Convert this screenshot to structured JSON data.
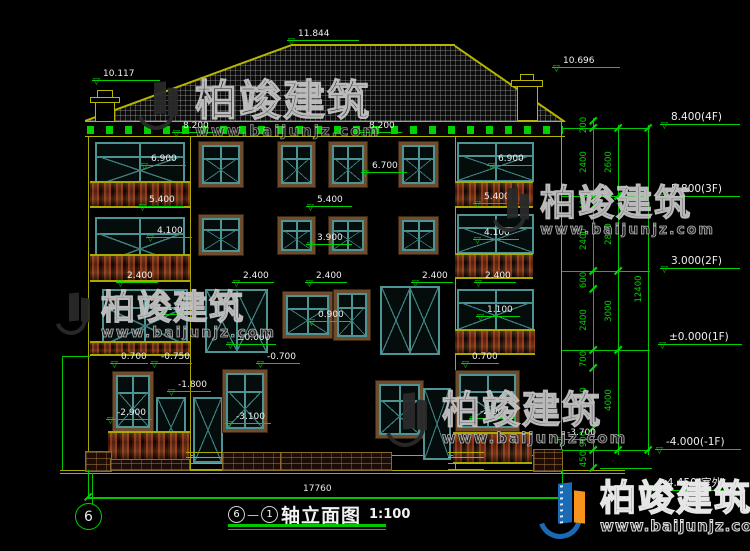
{
  "title": {
    "axis_start": "6",
    "separator": "—",
    "axis_end": "1",
    "name": "轴立面图",
    "scale": "1:100"
  },
  "axis_bubble": {
    "label": "6"
  },
  "watermark": {
    "brand": "柏竣建筑",
    "url": "www.baijunjz.com"
  },
  "dims": {
    "overall_width": "17760"
  },
  "colors": {
    "cad_yellow": "#a9a900",
    "cad_green": "#00d200",
    "window_teal": "#4e9494",
    "frame_brown": "#6e4c2e",
    "baluster_red": "#8a3418",
    "logo_blue": "#1a6ab5",
    "logo_orange": "#f7941d"
  },
  "levels": [
    {
      "t": "11.844",
      "x": 287,
      "y": 28,
      "w": 72
    },
    {
      "t": "10.117",
      "x": 92,
      "y": 68,
      "w": 68
    },
    {
      "t": "10.696",
      "x": 552,
      "y": 55,
      "w": 68
    },
    {
      "t": "8.200",
      "x": 172,
      "y": 120,
      "w": 44
    },
    {
      "t": "8.200",
      "x": 358,
      "y": 120,
      "w": 44
    },
    {
      "t": "6.900",
      "x": 140,
      "y": 153,
      "w": 46
    },
    {
      "t": "6.700",
      "x": 361,
      "y": 160,
      "w": 46
    },
    {
      "t": "6.900",
      "x": 487,
      "y": 153,
      "w": 46
    },
    {
      "t": "5.400",
      "x": 138,
      "y": 194,
      "w": 46
    },
    {
      "t": "5.400",
      "x": 306,
      "y": 194,
      "w": 46
    },
    {
      "t": "5.400",
      "x": 473,
      "y": 191,
      "w": 46
    },
    {
      "t": "4.100",
      "x": 146,
      "y": 225,
      "w": 46
    },
    {
      "t": "3.900",
      "x": 306,
      "y": 232,
      "w": 46
    },
    {
      "t": "4.100",
      "x": 473,
      "y": 227,
      "w": 46
    },
    {
      "t": "2.400",
      "x": 116,
      "y": 270,
      "w": 42
    },
    {
      "t": "2.400",
      "x": 232,
      "y": 270,
      "w": 42
    },
    {
      "t": "2.400",
      "x": 305,
      "y": 270,
      "w": 42
    },
    {
      "t": "2.400",
      "x": 411,
      "y": 270,
      "w": 42
    },
    {
      "t": "2.400",
      "x": 474,
      "y": 270,
      "w": 42
    },
    {
      "t": "1.100",
      "x": 156,
      "y": 302,
      "w": 44
    },
    {
      "t": "0.900",
      "x": 307,
      "y": 309,
      "w": 44
    },
    {
      "t": "1.100",
      "x": 476,
      "y": 304,
      "w": 44
    },
    {
      "t": "±0.000",
      "x": 226,
      "y": 332,
      "w": 50
    },
    {
      "t": "0.700",
      "x": 110,
      "y": 351,
      "w": 38
    },
    {
      "t": "-0.750",
      "x": 150,
      "y": 351,
      "w": 42
    },
    {
      "t": "-0.700",
      "x": 256,
      "y": 351,
      "w": 44
    },
    {
      "t": "0.700",
      "x": 461,
      "y": 351,
      "w": 38
    },
    {
      "t": "-1.800",
      "x": 167,
      "y": 379,
      "w": 44
    },
    {
      "t": "-2.900",
      "x": 106,
      "y": 407,
      "w": 46
    },
    {
      "t": "-3.100",
      "x": 225,
      "y": 411,
      "w": 46
    },
    {
      "t": "-2.900",
      "x": 469,
      "y": 406,
      "w": 46
    },
    {
      "t": "-3.700",
      "x": 556,
      "y": 427,
      "w": 42
    },
    {
      "t": "8.400(4F)",
      "x": 660,
      "y": 110,
      "w": 80,
      "big": 1
    },
    {
      "t": "5.800(3F)",
      "x": 660,
      "y": 182,
      "w": 80,
      "big": 1
    },
    {
      "t": "3.000(2F)",
      "x": 660,
      "y": 254,
      "w": 80,
      "big": 1
    },
    {
      "t": "±0.000(1F)",
      "x": 658,
      "y": 330,
      "w": 84,
      "big": 1
    },
    {
      "t": "-4.000(-1F)",
      "x": 655,
      "y": 435,
      "w": 86,
      "big": 1
    },
    {
      "t": "-4.450(室外)",
      "x": 652,
      "y": 476,
      "w": 84,
      "big": 1
    }
  ],
  "chains": [
    {
      "x": 593,
      "segs": [
        [
          "200",
          121,
          128
        ],
        [
          "2400",
          128,
          196
        ],
        [
          "400",
          196,
          207
        ],
        [
          "2400",
          207,
          271
        ],
        [
          "600",
          271,
          289
        ],
        [
          "2400",
          289,
          350
        ],
        [
          "700",
          350,
          368
        ],
        [
          "2400",
          368,
          428
        ],
        [
          "900",
          428,
          450
        ],
        [
          "450",
          450,
          468
        ]
      ]
    },
    {
      "x": 618,
      "segs": [
        [
          "2600",
          128,
          196
        ],
        [
          "2800",
          196,
          271
        ],
        [
          "3000",
          271,
          350
        ],
        [
          "4000",
          350,
          450
        ]
      ]
    },
    {
      "x": 648,
      "segs": [
        [
          "12400",
          128,
          450
        ]
      ]
    }
  ],
  "structures": [
    [
      "vl",
      88,
      137,
      333
    ],
    [
      "vl",
      561,
      121,
      352
    ],
    [
      "vl",
      190,
      137,
      333
    ],
    [
      "vl",
      455,
      137,
      333
    ],
    [
      "hl",
      60,
      470,
      565
    ],
    [
      "hl",
      60,
      473,
      565
    ],
    [
      "hl",
      88,
      455,
      474
    ],
    [
      "ww",
      95,
      142,
      90,
      45
    ],
    [
      "fw",
      198,
      141,
      46,
      47
    ],
    [
      "fw",
      277,
      141,
      39,
      47
    ],
    [
      "fw",
      328,
      141,
      40,
      47
    ],
    [
      "fw",
      398,
      141,
      41,
      47
    ],
    [
      "ww",
      457,
      142,
      77,
      40
    ],
    [
      "bal",
      90,
      181,
      100,
      27
    ],
    [
      "bal",
      455,
      181,
      78,
      27
    ],
    [
      "ww",
      95,
      217,
      90,
      50
    ],
    [
      "fw",
      198,
      214,
      46,
      42
    ],
    [
      "fw",
      277,
      216,
      39,
      39
    ],
    [
      "fw",
      328,
      216,
      40,
      39
    ],
    [
      "fw",
      398,
      216,
      41,
      39
    ],
    [
      "ww",
      457,
      214,
      77,
      40
    ],
    [
      "bal",
      90,
      254,
      100,
      28
    ],
    [
      "bal",
      455,
      253,
      78,
      26
    ],
    [
      "ww",
      102,
      289,
      86,
      58
    ],
    [
      "dd",
      205,
      289,
      63,
      64
    ],
    [
      "fw",
      282,
      291,
      51,
      48
    ],
    [
      "fw",
      333,
      289,
      38,
      52
    ],
    [
      "dd",
      380,
      286,
      60,
      69
    ],
    [
      "ww",
      457,
      289,
      77,
      42
    ],
    [
      "bal",
      90,
      341,
      100,
      15
    ],
    [
      "bal",
      455,
      329,
      80,
      26
    ],
    [
      "fw",
      112,
      371,
      42,
      61
    ],
    [
      "dr",
      156,
      397,
      30,
      61
    ],
    [
      "dr",
      193,
      397,
      30,
      66
    ],
    [
      "fw",
      222,
      369,
      46,
      64
    ],
    [
      "fw",
      375,
      380,
      49,
      59
    ],
    [
      "dr",
      423,
      388,
      28,
      72
    ],
    [
      "fw",
      455,
      370,
      65,
      62
    ],
    [
      "bal",
      108,
      431,
      82,
      30
    ],
    [
      "bal",
      453,
      432,
      79,
      32
    ],
    [
      "steps",
      186,
      452,
      44,
      18
    ],
    [
      "steps",
      448,
      452,
      36,
      18
    ],
    [
      "brick",
      85,
      451,
      27,
      21
    ],
    [
      "brick",
      110,
      459,
      80,
      12
    ],
    [
      "brick",
      222,
      452,
      86,
      19
    ],
    [
      "brick",
      280,
      452,
      112,
      19
    ],
    [
      "brick",
      533,
      449,
      30,
      23
    ],
    [
      "gvl",
      593,
      118,
      352
    ],
    [
      "gvl",
      618,
      125,
      330
    ],
    [
      "gvl",
      648,
      125,
      330
    ],
    [
      "ghl",
      562,
      128,
      88
    ],
    [
      "ghl",
      562,
      196,
      88
    ],
    [
      "ghl",
      562,
      271,
      88
    ],
    [
      "ghl",
      562,
      350,
      88
    ],
    [
      "ghl",
      562,
      450,
      88
    ],
    [
      "ghl",
      600,
      468,
      52
    ],
    [
      "gvl",
      88,
      470,
      28
    ],
    [
      "gvl",
      562,
      470,
      28
    ],
    [
      "gvl",
      92,
      473,
      31
    ],
    [
      "ghl",
      62,
      356,
      28
    ],
    [
      "gvl",
      62,
      356,
      114
    ]
  ]
}
